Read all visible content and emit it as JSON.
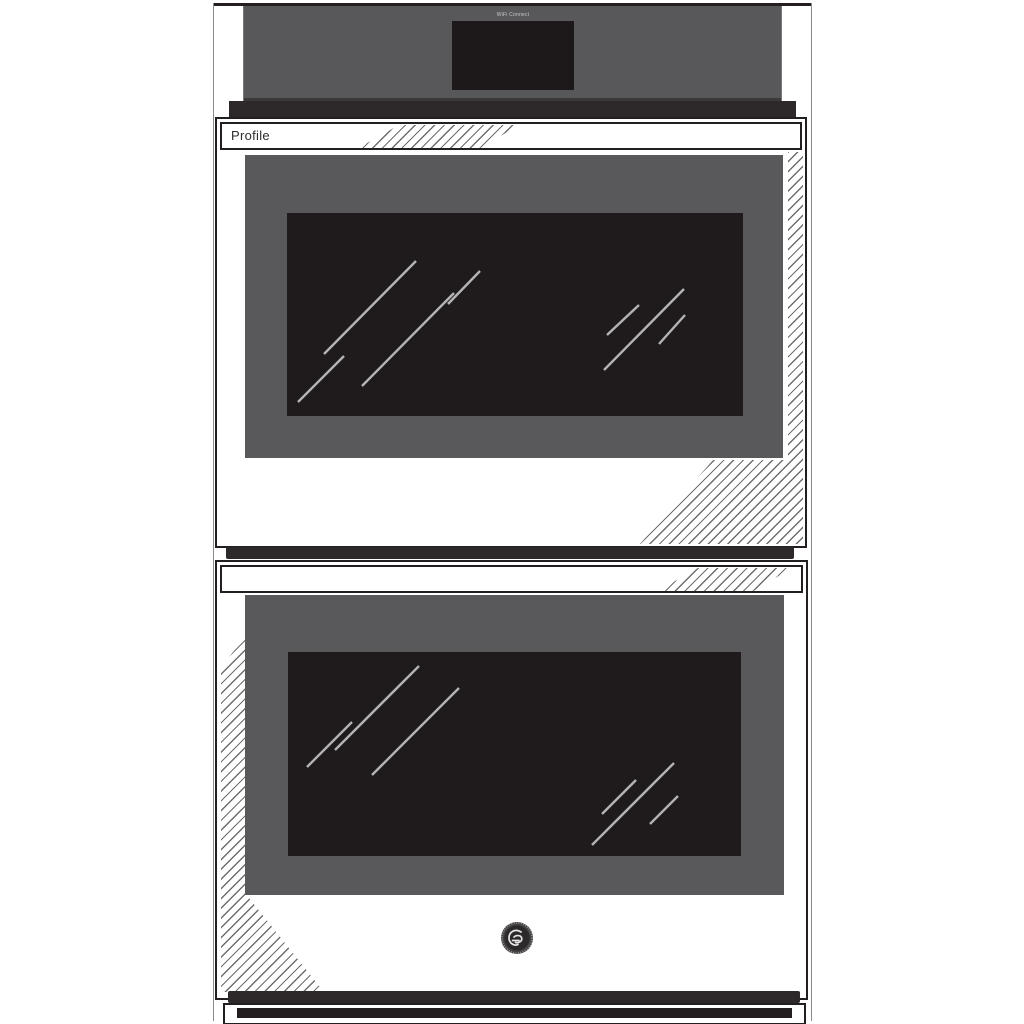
{
  "meta": {
    "title": "GE Profile built-in double wall oven — grayscale product illustration",
    "background_color": "#ffffff"
  },
  "branding": {
    "series_label": "Profile",
    "wifi_label": "WiFi Connect",
    "logo_name": "GE monogram"
  },
  "control_panel": {
    "description": "full-width gray control panel with centered black touchscreen display and white side trims",
    "panel_color": "#58585a",
    "display_color": "#1d191a"
  },
  "upper_oven": {
    "description": "upper oven door with white handle bar, gray inner panel, black glass window with diagonal reflections, hatched shading on right and lower-right",
    "door_panel_color": "#59585a",
    "window_color": "#1f1b1c"
  },
  "lower_oven": {
    "description": "lower oven door with white handle bar, gray inner panel, black glass window with diagonal reflections, hatched shading on left, GE monogram badge below window",
    "door_panel_color": "#59585a",
    "window_color": "#1f1b1c"
  },
  "colors": {
    "outline": "#231f20",
    "shadow_strip": "#2d292a",
    "hatch_line": "#6e6e6e",
    "reflection_line": "#b4b4b4",
    "trim_white": "#ffffff"
  }
}
